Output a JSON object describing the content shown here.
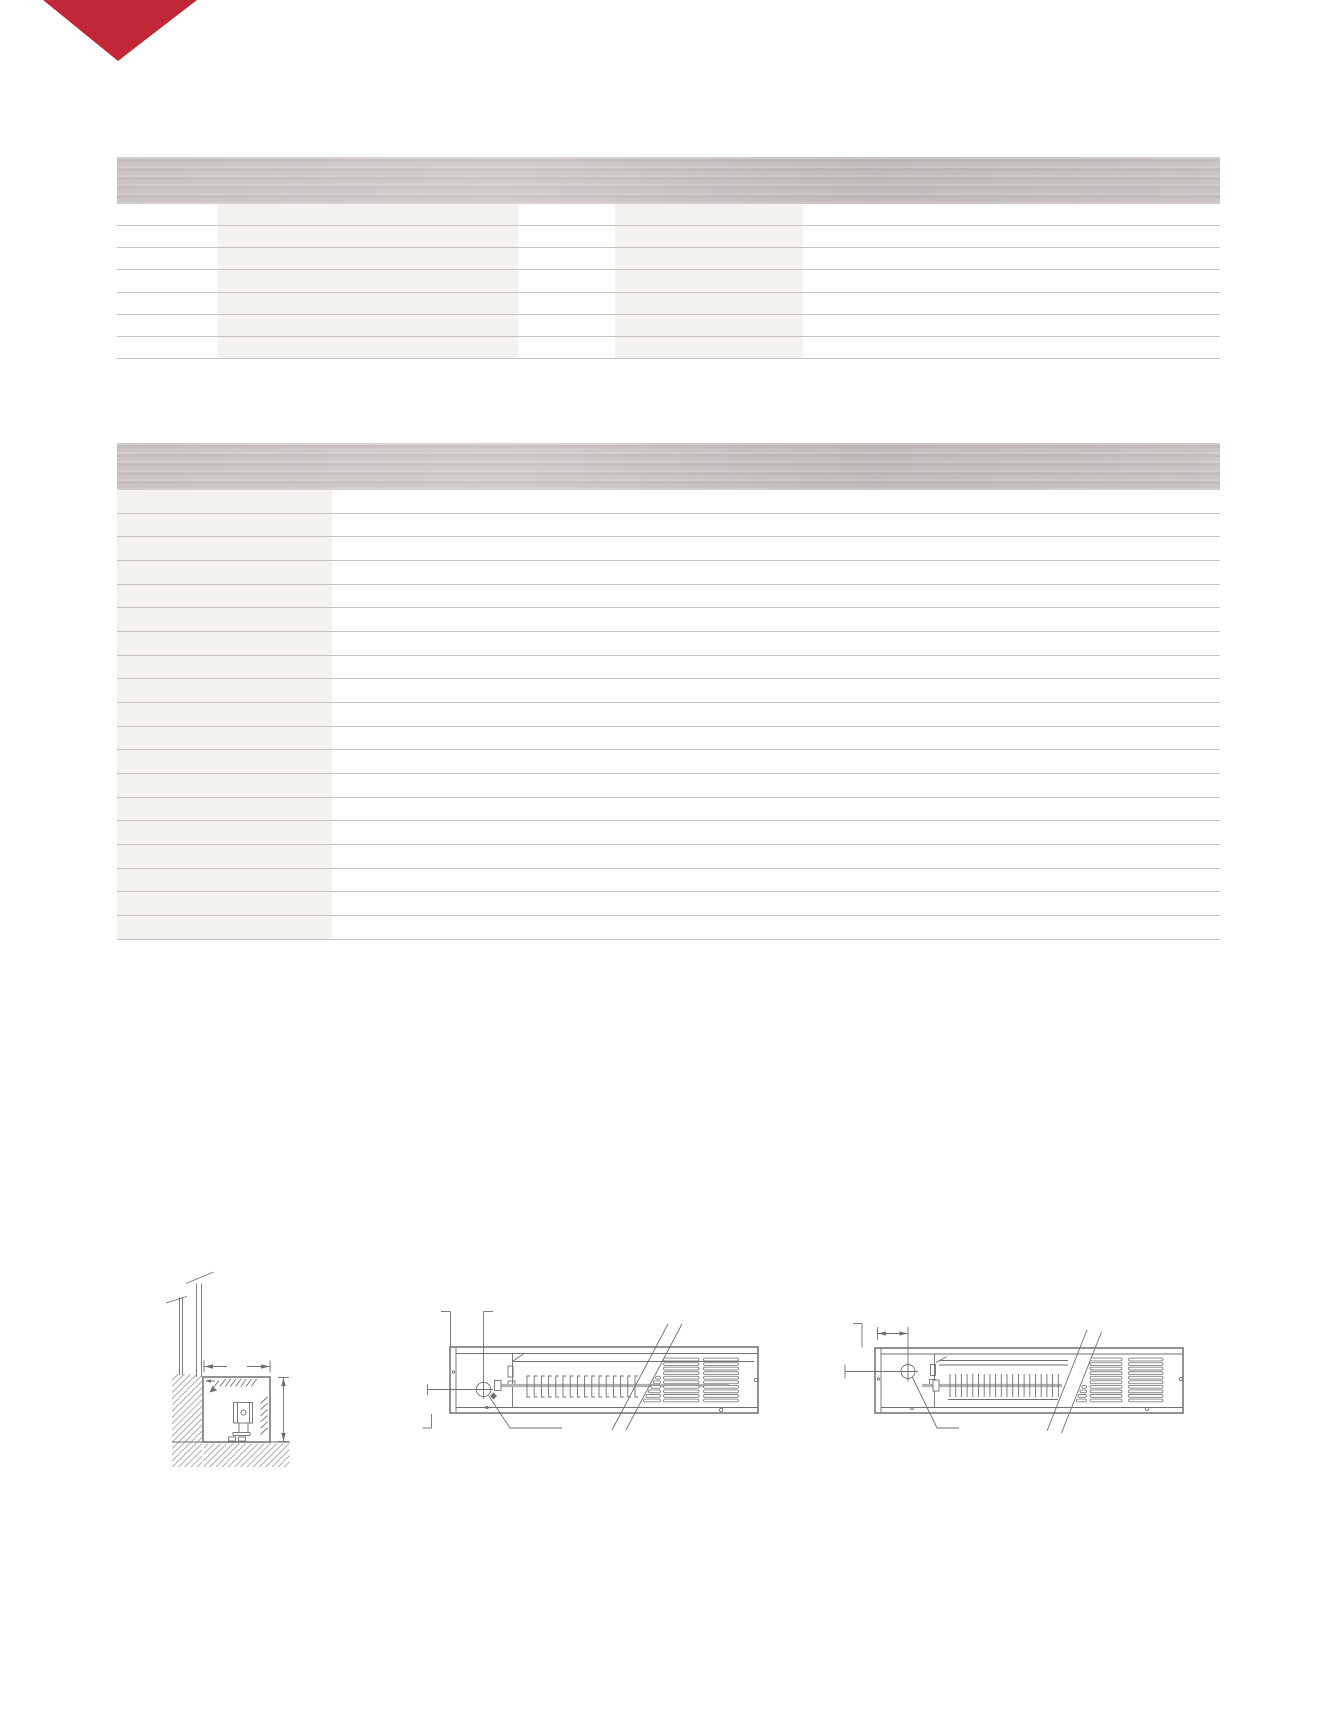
{
  "page": {
    "width": 1338,
    "height": 1731,
    "visible_text": ""
  },
  "colors": {
    "page-bg": "#ffffff",
    "accent": "#c22737",
    "header-hi": "#d2cdcb",
    "header-mid": "#cac5c3",
    "header-lo": "#c1bcba",
    "col-band": "#f4f2ee",
    "row-line": "#c6c3c1",
    "draw-line": "#6f6f6f",
    "draw-soft": "#b2b2b2",
    "hatch": "#979797",
    "slat": "#828282"
  },
  "logo": {
    "icon": "triangle-down-icon",
    "shape": "downward-pointing-triangle"
  },
  "tables": {
    "table1": {
      "header_label": "",
      "row_count": 7,
      "row_height": 22.14,
      "geometry": {
        "left": 117,
        "top": 157,
        "width": 1103,
        "header_height": 47,
        "body_height": 155
      },
      "shaded_columns": [
        {
          "left": 101,
          "width": 300
        },
        {
          "left": 498,
          "width": 188
        }
      ],
      "cells_text": []
    },
    "table2": {
      "header_label": "",
      "row_count": 19,
      "row_height": 23.68,
      "geometry": {
        "left": 117,
        "top": 443,
        "width": 1103,
        "header_height": 47,
        "body_height": 450
      },
      "shaded_columns": [
        {
          "left": 0,
          "width": 215
        }
      ],
      "cells_text": []
    }
  },
  "drawings": {
    "figures": [
      "trench-convector-wall-section-view",
      "trench-convector-plan-view-with-grille",
      "trench-convector-plan-view-long-coil"
    ],
    "fin_rows": [
      {
        "target": "g-mid-fins",
        "style": "bracket",
        "x0": 527,
        "dx": 7.2,
        "count": 16,
        "y0": 1376,
        "y1": 1397,
        "flange": 3.2
      },
      {
        "target": "g-right-fins",
        "style": "bar",
        "x0": 950,
        "dx": 5.7,
        "count": 20,
        "y0": 1374,
        "y1": 1397
      }
    ],
    "grilles": [
      {
        "target": "g-mid-grille",
        "x0": 663.5,
        "x1": 699,
        "y0": 1359.5,
        "dy": 4.55,
        "slats": 10
      },
      {
        "target": "g-mid-grille",
        "x0": 703.5,
        "x1": 738.5,
        "y0": 1359.5,
        "dy": 4.55,
        "slats": 10
      },
      {
        "target": "g-right-grille",
        "x0": 1090,
        "x1": 1122,
        "y0": 1359.5,
        "dy": 4.55,
        "slats": 10
      },
      {
        "target": "g-right-grille",
        "x0": 1128.5,
        "x1": 1163,
        "y0": 1359.5,
        "dy": 4.55,
        "slats": 10
      }
    ],
    "partial_slats": [
      {
        "target": "g-mid-grille",
        "x1": 660.5,
        "y0": 1359.5,
        "dy": 4.55,
        "slats": 10,
        "edge": [
          626,
          1430,
          682,
          1324
        ]
      },
      {
        "target": "g-right-grille",
        "x1": 1086.5,
        "y0": 1359.5,
        "dy": 4.55,
        "slats": 10,
        "edge": [
          1061.5,
          1433,
          1101.5,
          1332
        ]
      }
    ],
    "tick_rows": [
      {
        "target": "g-section-ticks",
        "x0": 220,
        "y0": 1386.5,
        "dx": 5.2,
        "dy": 0,
        "lx": 5.5,
        "ly": -7.5,
        "count": 7
      },
      {
        "target": "g-section-ticks",
        "x0": 260.5,
        "y0": 1403.5,
        "dx": 0,
        "dy": 6.2,
        "lx": 7,
        "ly": -6.5,
        "count": 6
      }
    ]
  }
}
